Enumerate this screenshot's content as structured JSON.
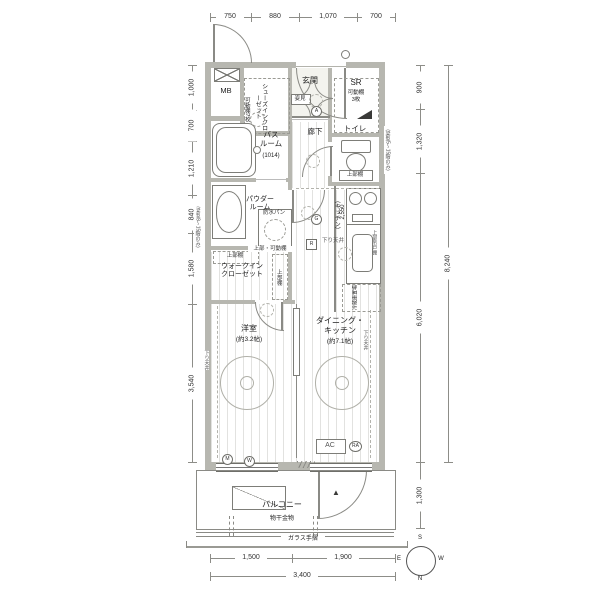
{
  "rooms": {
    "mb": "MB",
    "shoes": "シューズインクローゼット",
    "shoes_shelf": "可動棚7枚",
    "genkan": "玄関",
    "mirror": "姿見",
    "sr": "SR",
    "sr_shelf": "可動棚\n3枚",
    "toilet": "トイレ",
    "toilet_shelf": "上部棚",
    "hall": "廊下",
    "bath": "バス\nルーム",
    "bath_size": "(1014)",
    "powder": "パウダー\nルーム",
    "pan": "防水パン",
    "pan_shelf": "上部・可動棚",
    "wic": "ウォークイン\nクローゼット",
    "wic_shelf_top": "上部棚",
    "wic_shelf_side": "上部棚",
    "kitchen": "（キッチン）",
    "kitchen_len": "2,550",
    "kitchen_hood": "上部吊戸棚",
    "fridge": "冷蔵庫置場",
    "western": "洋室",
    "western_size": "(約3.2帖)",
    "dk": "ダイニング・\nキッチン",
    "dk_size": "(約7.1帖)",
    "balcony": "バルコニー",
    "laundry": "物干金物",
    "rail": "ガラス手摺",
    "ac": "AC"
  },
  "notes": {
    "ceiling_left": "下り天井",
    "ceiling_right": "下り天井",
    "ceiling_mid": "下り天井",
    "beam_left": "（梁型8〜15階のみ）",
    "beam_right": "（梁型5〜15階のみ）"
  },
  "symbols": {
    "m": "M",
    "w": "W",
    "g": "G",
    "r": "R",
    "a": "A",
    "ra": "RA"
  },
  "compass": {
    "n": "N",
    "s": "S",
    "e": "E",
    "w": "W"
  },
  "dimensions": {
    "top": [
      "750",
      "880",
      "1,070",
      "700"
    ],
    "left": [
      "1,000",
      "700",
      "1,210",
      "840",
      "1,580",
      "3,540"
    ],
    "right": [
      "900",
      "1,320",
      "6,020",
      "1,300"
    ],
    "right_total": "8,240",
    "bottom": [
      "1,500",
      "1,900"
    ],
    "bottom_total": "3,400"
  }
}
